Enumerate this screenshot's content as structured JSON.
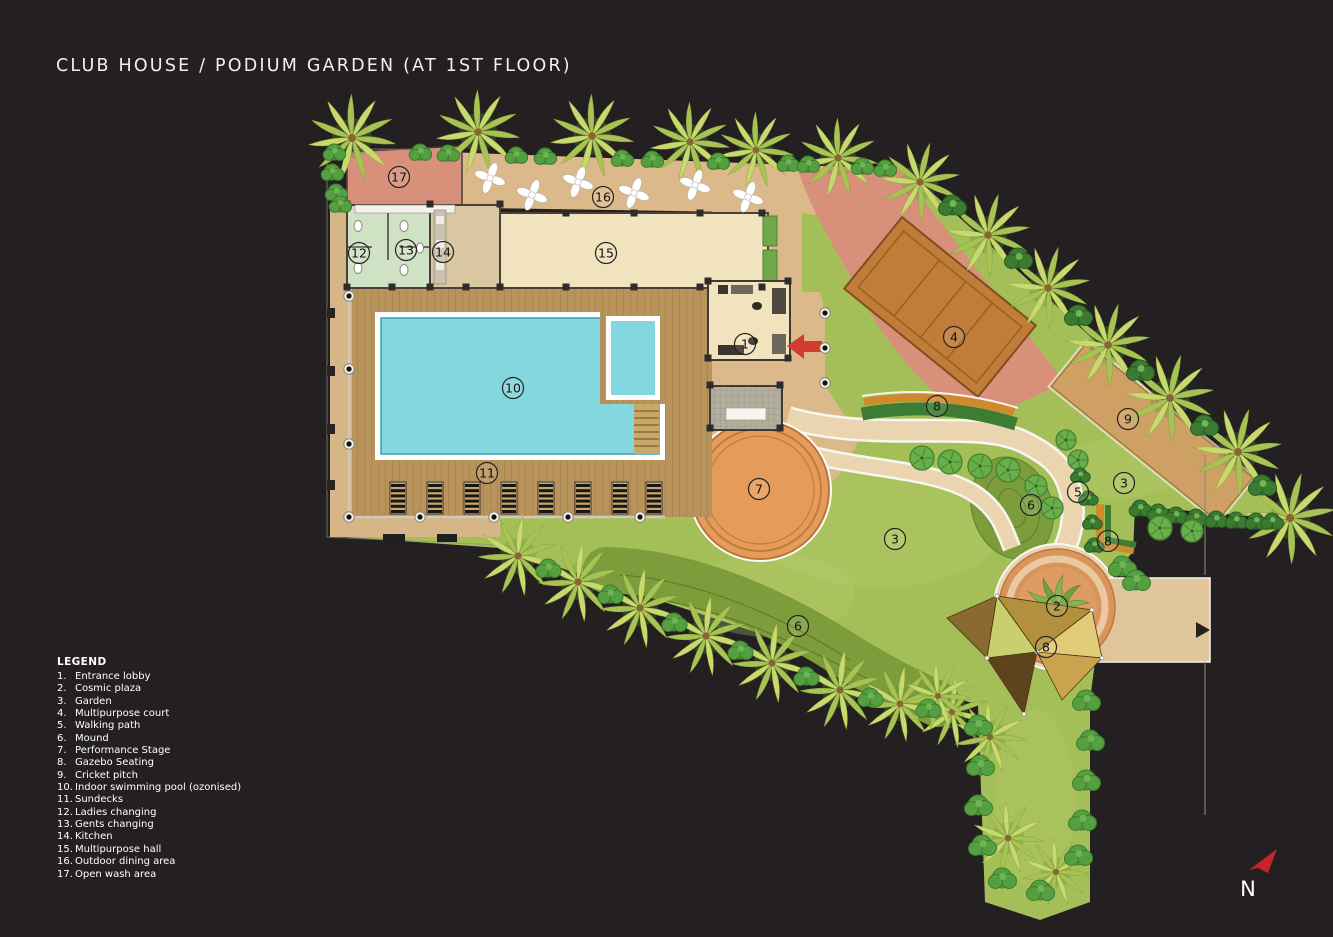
{
  "title": "CLUB HOUSE / PODIUM GARDEN (AT 1ST FLOOR)",
  "legend": {
    "heading": "LEGEND",
    "items": [
      {
        "num": "1.",
        "label": "Entrance lobby"
      },
      {
        "num": "2.",
        "label": "Cosmic plaza"
      },
      {
        "num": "3.",
        "label": "Garden"
      },
      {
        "num": "4.",
        "label": "Multipurpose court"
      },
      {
        "num": "5.",
        "label": "Walking path"
      },
      {
        "num": "6.",
        "label": "Mound"
      },
      {
        "num": "7.",
        "label": "Performance Stage"
      },
      {
        "num": "8.",
        "label": "Gazebo Seating"
      },
      {
        "num": "9.",
        "label": "Cricket pitch"
      },
      {
        "num": "10.",
        "label": "Indoor swimming pool (ozonised)"
      },
      {
        "num": "11.",
        "label": "Sundecks"
      },
      {
        "num": "12.",
        "label": "Ladies changing"
      },
      {
        "num": "13.",
        "label": "Gents changing"
      },
      {
        "num": "14.",
        "label": "Kitchen"
      },
      {
        "num": "15.",
        "label": "Multipurpose hall"
      },
      {
        "num": "16.",
        "label": "Outdoor dining area"
      },
      {
        "num": "17.",
        "label": "Open wash area"
      }
    ]
  },
  "plan": {
    "markers": [
      {
        "n": "17",
        "x": 399,
        "y": 177
      },
      {
        "n": "16",
        "x": 603,
        "y": 197
      },
      {
        "n": "12",
        "x": 359,
        "y": 253
      },
      {
        "n": "13",
        "x": 406,
        "y": 250
      },
      {
        "n": "14",
        "x": 443,
        "y": 252
      },
      {
        "n": "15",
        "x": 606,
        "y": 253
      },
      {
        "n": "1",
        "x": 745,
        "y": 344
      },
      {
        "n": "10",
        "x": 513,
        "y": 388
      },
      {
        "n": "11",
        "x": 487,
        "y": 473
      },
      {
        "n": "7",
        "x": 759,
        "y": 489
      },
      {
        "n": "4",
        "x": 954,
        "y": 337
      },
      {
        "n": "8",
        "x": 937,
        "y": 406
      },
      {
        "n": "9",
        "x": 1128,
        "y": 419
      },
      {
        "n": "3",
        "x": 1124,
        "y": 483
      },
      {
        "n": "5",
        "x": 1078,
        "y": 492
      },
      {
        "n": "6",
        "x": 1031,
        "y": 505
      },
      {
        "n": "8",
        "x": 1108,
        "y": 541
      },
      {
        "n": "3",
        "x": 895,
        "y": 539
      },
      {
        "n": "2",
        "x": 1057,
        "y": 606
      },
      {
        "n": "8",
        "x": 1046,
        "y": 647
      },
      {
        "n": "6",
        "x": 798,
        "y": 626
      }
    ]
  },
  "north_label": "N",
  "colors": {
    "background": "#242021",
    "grass": "#a5bf58",
    "mound_green": "#7d9c3c",
    "pool_water": "#84d7de",
    "deck_wood": "#b8935c",
    "path_tan": "#dcb98b",
    "walk_path": "#ead5b0",
    "pink_area": "#d8907b",
    "court_brown": "#c07c38",
    "stage_orange": "#e59c5a",
    "plaza_orange": "#d9945a",
    "pitch_tan": "#cfa064",
    "hedge_green": "#3d7c33",
    "orange_path": "#cf8a2d",
    "palm_leaf": "#c9d96d",
    "room_cream": "#f1e3bd",
    "room_green": "#cfe2c4",
    "room_tan": "#d9c7a1",
    "north_red": "#c8232b",
    "text_white": "#f2f0ee"
  }
}
